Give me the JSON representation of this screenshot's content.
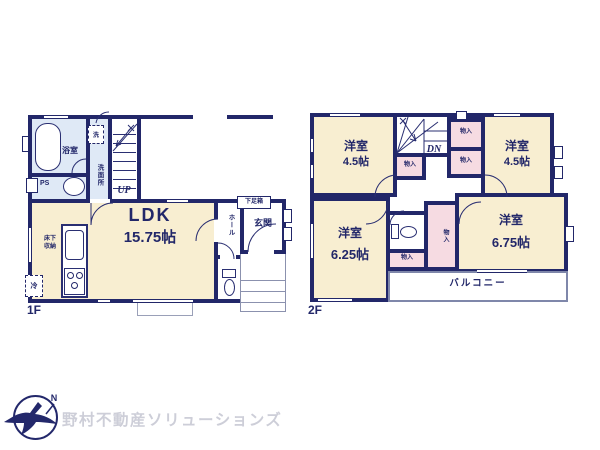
{
  "colors": {
    "wall": "#222769",
    "room_cream": "#f8eed1",
    "wet_blue": "#dfe9f6",
    "closet_pink": "#f6dbe2",
    "logo_navy": "#23286b",
    "logo_gray": "#cdced8"
  },
  "floor1": {
    "label": "1F",
    "bath": "浴室",
    "washer": "洗",
    "washroom": "洗面所",
    "ps": "PS",
    "up": "UP",
    "ldk": {
      "name": "LDK",
      "size": "15.75帖"
    },
    "underfloor_line1": "床下",
    "underfloor_line2": "収納",
    "fridge": "冷",
    "hall": "ホール",
    "entrance": "玄関",
    "shoebox": "下足箱"
  },
  "floor2": {
    "label": "2F",
    "dn": "DN",
    "balcony": "バルコニー",
    "rooms": {
      "nw": {
        "name": "洋室",
        "size": "4.5帖"
      },
      "ne": {
        "name": "洋室",
        "size": "4.5帖"
      },
      "sw": {
        "name": "洋室",
        "size": "6.25帖"
      },
      "se": {
        "name": "洋室",
        "size": "6.75帖"
      }
    },
    "closets": [
      "物入",
      "物入",
      "物入",
      "物入",
      "物入"
    ]
  },
  "logo": {
    "mark": "N",
    "company": "野村不動産ソリューションズ"
  }
}
